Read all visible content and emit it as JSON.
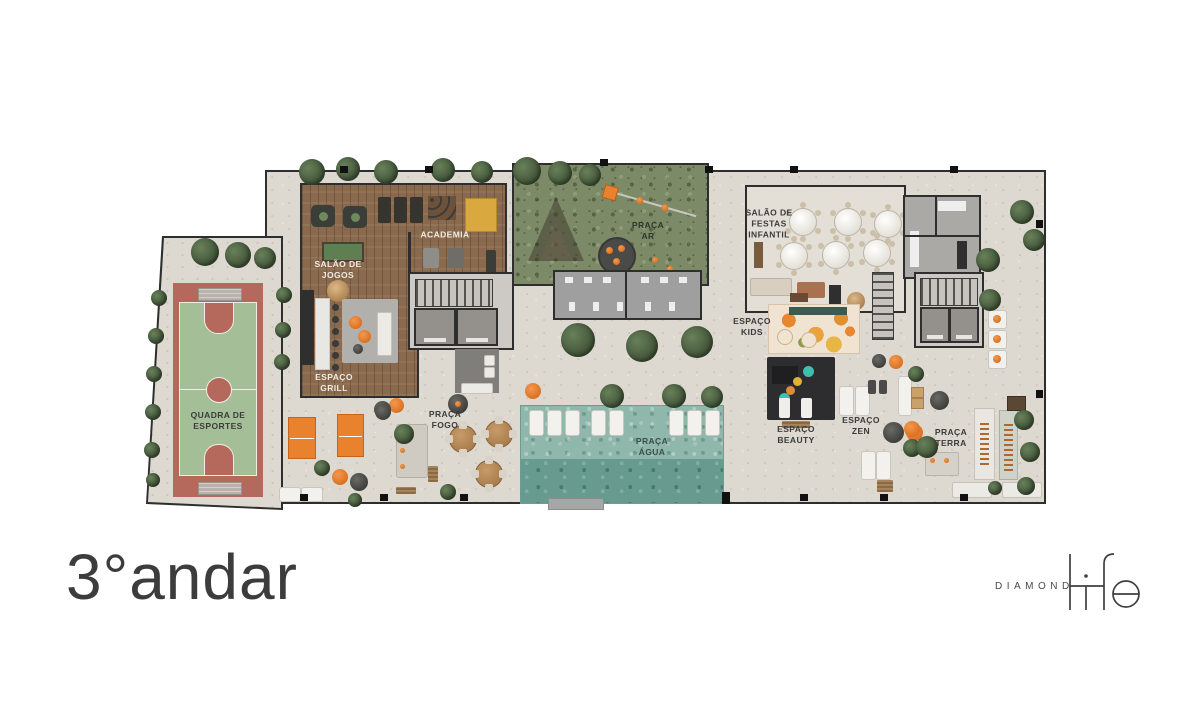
{
  "page": {
    "floor_title": "3°andar"
  },
  "brand": {
    "name": "DIAMOND",
    "logo": "Life"
  },
  "colors": {
    "floor": "#ddd8d0",
    "wood": "#8a6a4e",
    "grass": "#7d8a68",
    "pool_light": "#8fb7ab",
    "pool_dark": "#679b8f",
    "court_base": "#b4695c",
    "court_green": "#a4bf98",
    "accent_orange": "#e8822f",
    "wall": "#2e2e2e",
    "tree_green": "#4c5f40"
  },
  "areas": {
    "quadra_esportes": {
      "label": "QUADRA DE\nESPORTES"
    },
    "salao_jogos": {
      "label": "SALÃO DE\nJOGOS"
    },
    "academia": {
      "label": "ACADEMIA"
    },
    "praca_ar": {
      "label": "PRAÇA\nAR"
    },
    "salao_festas_infantil": {
      "label": "SALÃO DE\nFESTAS\nINFANTIL"
    },
    "espaco_kids": {
      "label": "ESPAÇO\nKIDS"
    },
    "espaco_grill": {
      "label": "ESPAÇO\nGRILL"
    },
    "praca_fogo": {
      "label": "PRAÇA\nFOGO"
    },
    "praca_agua": {
      "label": "PRAÇA\nÁGUA"
    },
    "espaco_beauty": {
      "label": "ESPAÇO\nBEAUTY"
    },
    "espaco_zen": {
      "label": "ESPAÇO\nZEN"
    },
    "praca_terra": {
      "label": "PRAÇA\nTERRA"
    }
  }
}
